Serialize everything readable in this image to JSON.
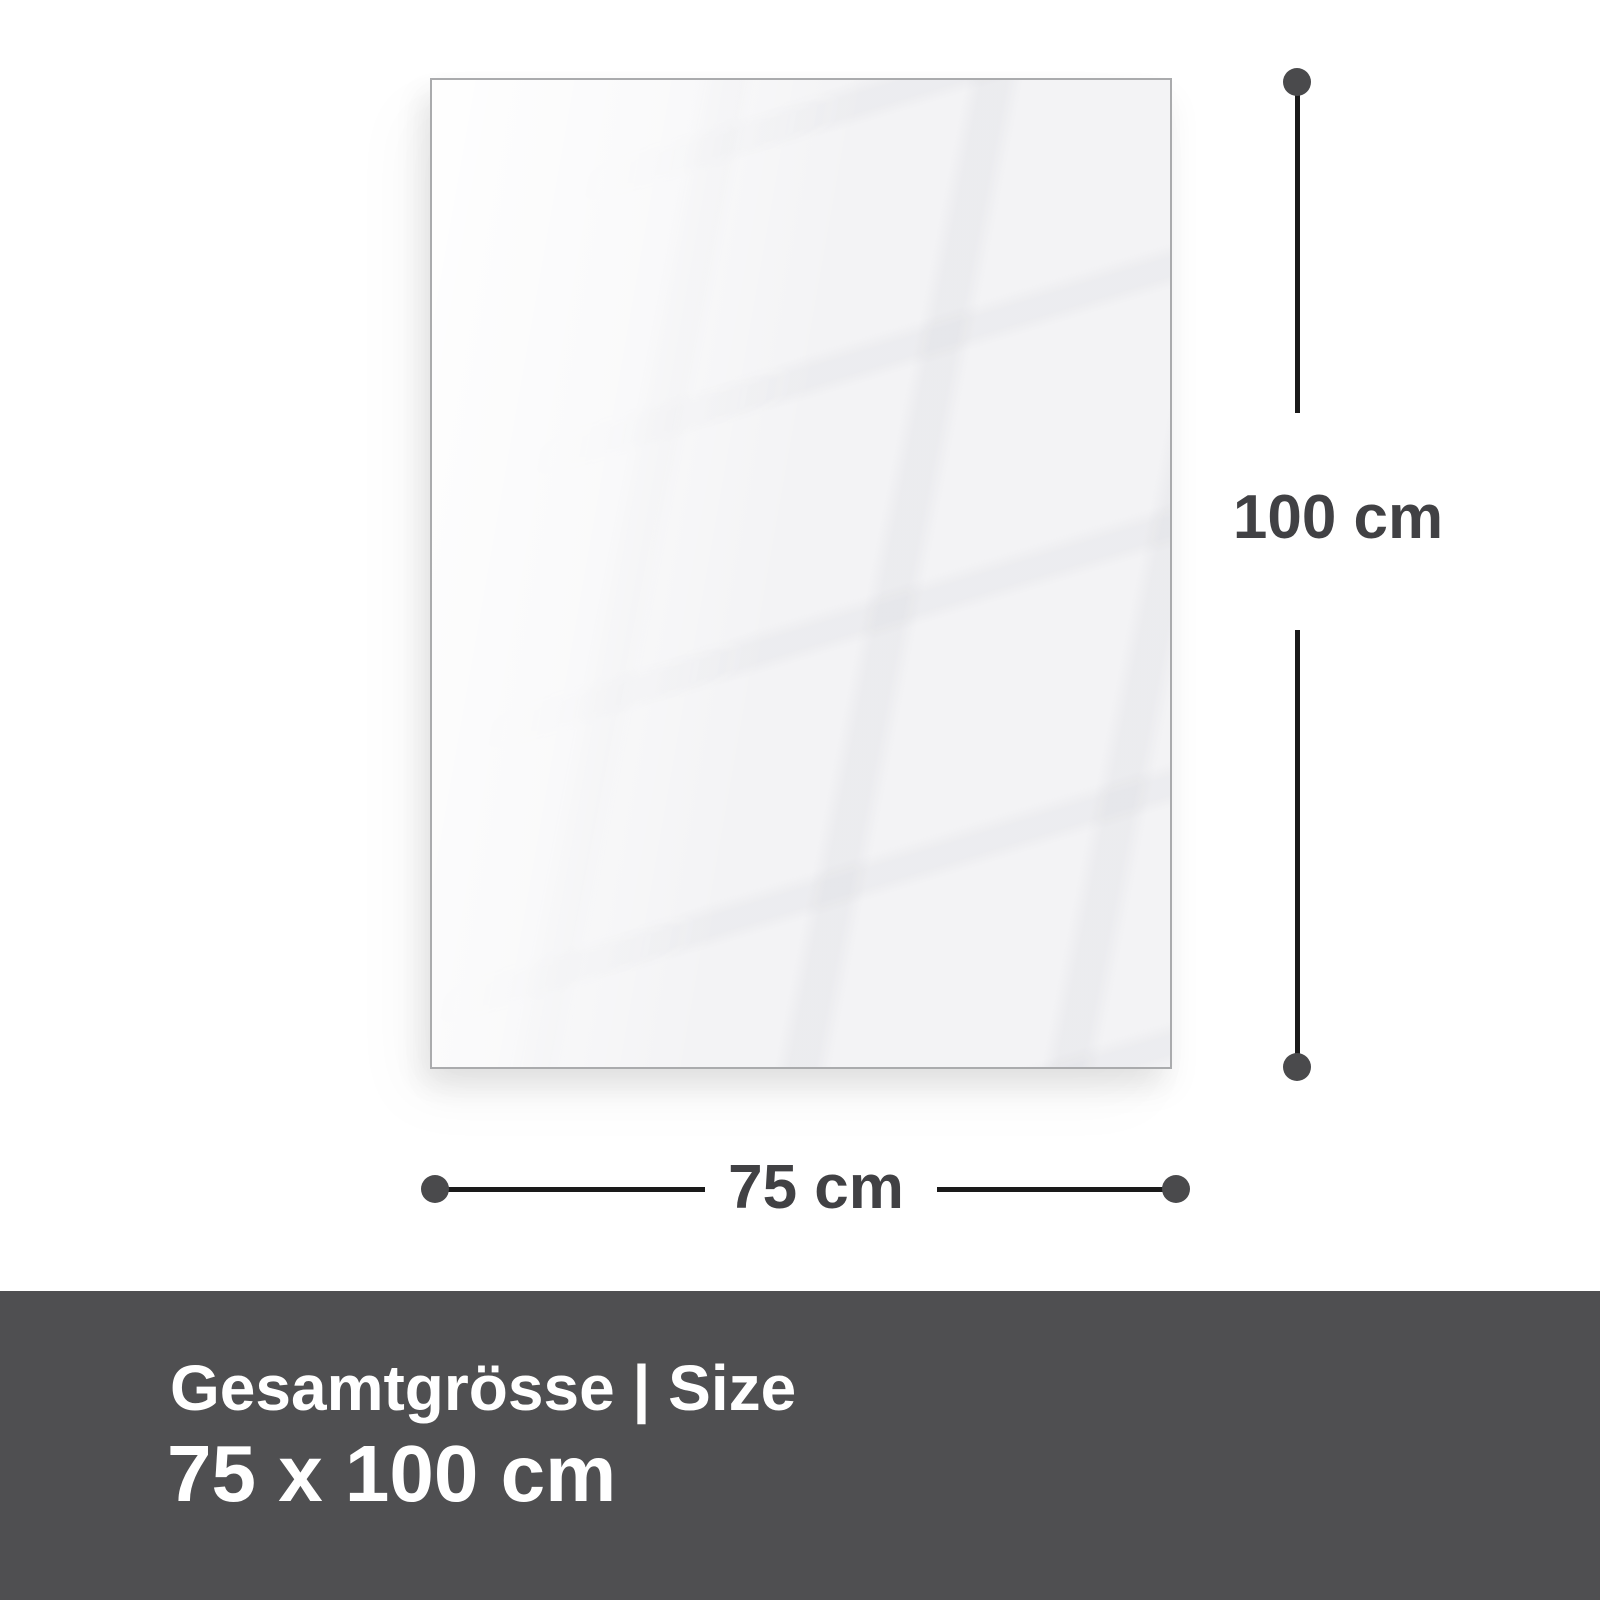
{
  "page": {
    "background_color": "#ffffff"
  },
  "panel": {
    "fill_color": "#f3f3f5",
    "border_color": "#aaabad"
  },
  "dimensions": {
    "height_label": "100 cm",
    "width_label": "75 cm",
    "label_color": "#414144",
    "line_color": "#1a1a1a",
    "dot_color": "#4a4a4c"
  },
  "footer": {
    "title": "Gesamtgrösse | Size",
    "size_value": "75 x 100 cm",
    "background_color": "#4f4f51",
    "text_color": "#ffffff"
  }
}
